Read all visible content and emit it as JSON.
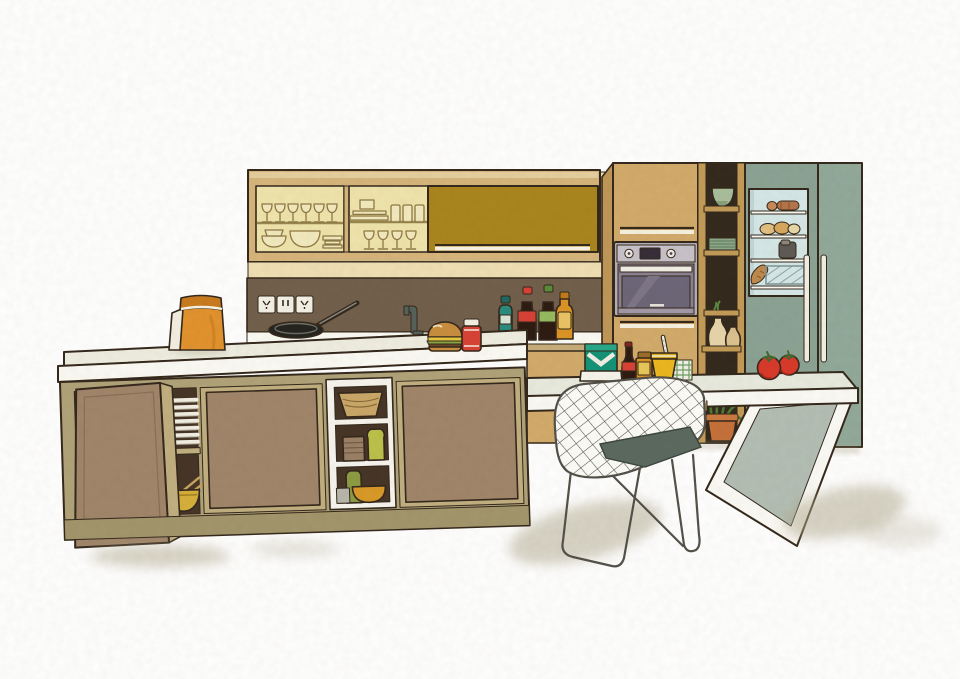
{
  "scene": {
    "title": "Modern kitchen illustration",
    "description": "Hand-drawn watercolor illustration of a modern kitchen: upper cabinet with glassware and a gold sliding door, dark backsplash with power outlets, frying pan and faucet on the rear counter, soda bottles, tall oven cabinet, open shelves with dishes and plants, sage-green refrigerator with food visible inside, a kitchen island with open doors showing plates and bowls, a paper bag, and a white dining table with snacks, tomatoes and a wire chair."
  },
  "palette": {
    "ink": "#35291c",
    "cream": "#f0e0b4",
    "cabTan": "#d7b67c",
    "glassPanel": "#f0e5ad",
    "gold": "#ab861e",
    "goldHandle": "#f7f3e6",
    "splash": "#72604c",
    "counterWhite": "#fbfaf4",
    "counterEdge": "#c8ae7a",
    "tallTan": "#d3ac6b",
    "tallSide": "#bf9758",
    "colInner": "#342a1d",
    "shelfWood": "#c49c58",
    "ovenFrame": "#b7afb7",
    "ovenPanel": "#c8c2ca",
    "ovenDisplay": "#362f3a",
    "ovenDoor": "#8b8294",
    "ovenGlass": "#6e6779",
    "fridge": "#8ca394",
    "fridgeR": "#92aa9b",
    "fridgeIn": "#d6e8e8",
    "islFrame": "#b1a379",
    "islDoor": "#a1866a",
    "islDoorEdge": "#c2b081",
    "islInner": "#473627",
    "islBase": "#a3966c",
    "tableTop": "#e9ebdf",
    "legFill": "#b4bfb4",
    "wire": "#54514a",
    "seatPad": "#5c6a60",
    "stoolWood": "#c8a766",
    "bagOrange": "#e2932e",
    "bagDeep": "#c97b1e",
    "panBlack": "#26241f",
    "tealBottle": "#2b8c80",
    "cola": "#2e1b12",
    "labelRed": "#d94236",
    "labelGreen": "#96bb5f",
    "amber": "#dd9526",
    "yellowCup": "#ecb91f",
    "boxTeal": "#149377",
    "tomato": "#d93a2b",
    "leaf": "#5a8a3f",
    "terracotta": "#c5713a",
    "shadow": "#b0a98c",
    "woodBowl": "#caa869",
    "greenBowlCol": "#a9bf9b",
    "greenPlates": "#8fa98a",
    "jugCream": "#e9d6ac"
  },
  "objects": {
    "wall_cabinet": {
      "label": "upper wall cabinet",
      "contents": [
        "wine glasses",
        "stacked bowls",
        "cup on plates",
        "tumblers"
      ],
      "door": "gold sliding door with white handle strip"
    },
    "backsplash": {
      "label": "dark taupe backsplash",
      "outlets": 3
    },
    "rear_counter": {
      "items": [
        "frying pan",
        "faucet",
        "teal bottle",
        "cola bottle red label",
        "cola bottle green label",
        "amber sauce bottle"
      ]
    },
    "tall_cabinet": {
      "label": "tall oven cabinet",
      "oven": "built-in oven with two knobs and display"
    },
    "shelf_column": {
      "items": [
        "green bowl",
        "stack of green plates",
        "two ceramic jugs with sprig",
        "potted plant"
      ]
    },
    "refrigerator": {
      "doors": 2,
      "handles": 2,
      "interior_items": [
        "sausage",
        "croissants and eggs",
        "jar",
        "baguette",
        "wire rack"
      ]
    },
    "island": {
      "compartments": [
        "open door with stacked plates and bowl with chopsticks",
        "closed door",
        "open white shelves with wooden bowl, striped cup, green vase, carafe, gray cup, amber bowl",
        "closed door"
      ],
      "on_top": [
        "paper bag",
        "burger",
        "ketchup jar"
      ]
    },
    "dining_table": {
      "items": [
        "white book",
        "teal box with white chevron",
        "small cola bottle",
        "mustard jar",
        "yellow drink cup with straw",
        "checkered cloth",
        "two tomatoes"
      ]
    },
    "seating": [
      "white wire chair with dark seat pad",
      "wooden stool"
    ]
  }
}
